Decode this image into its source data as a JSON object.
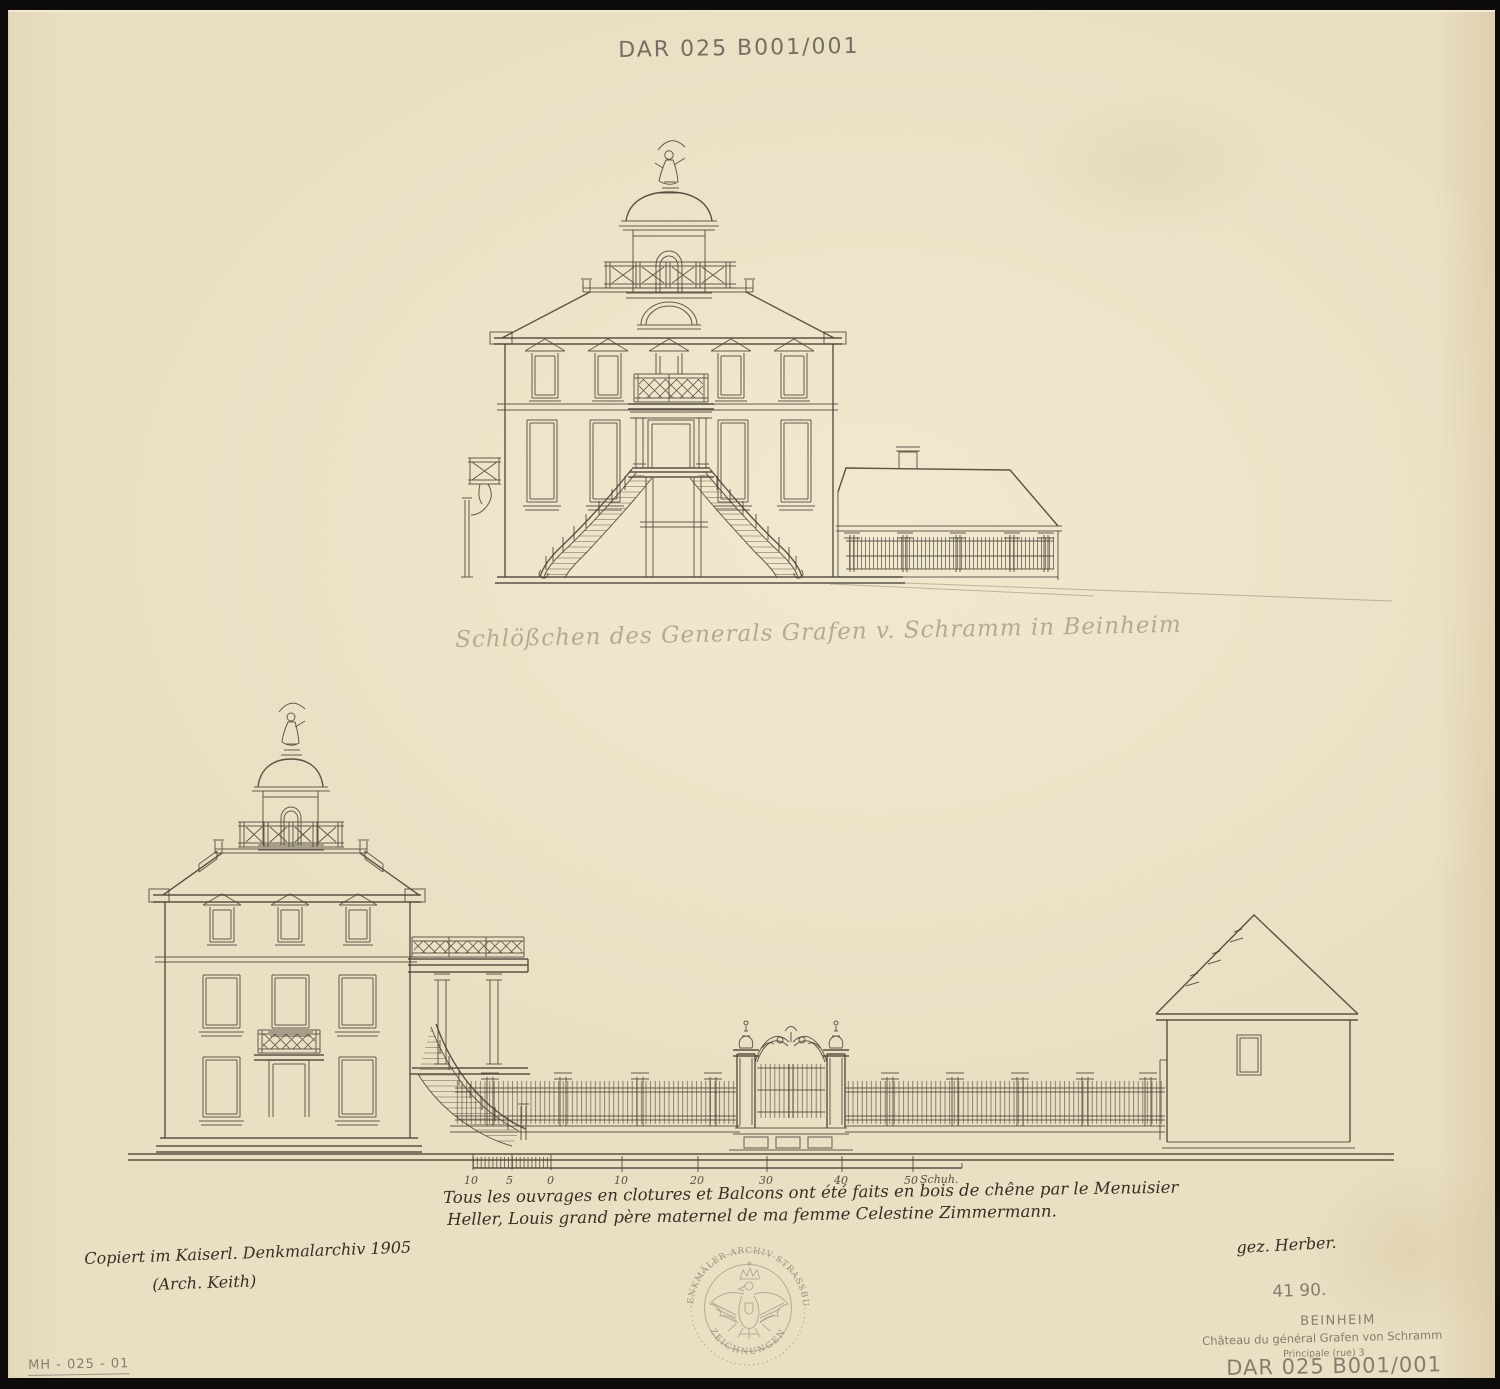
{
  "page": {
    "archive_code_top": "DAR 025 B001/001",
    "pencil_caption": "Schlößchen des Generals Grafen v. Schramm in Beinheim",
    "handwritten_note_line1": "Tous les ouvrages en clotures et Balcons ont été faits en bois de chêne par le Menuisier",
    "handwritten_note_line2": "Heller, Louis grand père maternel de ma femme Celestine Zimmermann.",
    "copy_note_line1": "Copiert im Kaiserl. Denkmalarchiv 1905",
    "copy_note_line2": "(Arch. Keith)",
    "signature": "gez. Herber.",
    "number_note": "41 90.",
    "location_title": "BEINHEIM",
    "location_subtitle": "Château du général Grafen von Schramm",
    "location_street": "Principale (rue) 3",
    "archive_code_bottom": "DAR 025 B001/001",
    "inventory_code": "MH - 025 - 01"
  },
  "scale_bar": {
    "labels": [
      "10",
      "5",
      "0",
      "10",
      "20",
      "30",
      "40",
      "50"
    ],
    "unit": "Schuh."
  },
  "stamp": {
    "arc_top": "KAIS. DENKMÄLER-ARCHIV STRASSBURG i/E.",
    "arc_bottom": "ZEICHNUNGEN"
  }
}
